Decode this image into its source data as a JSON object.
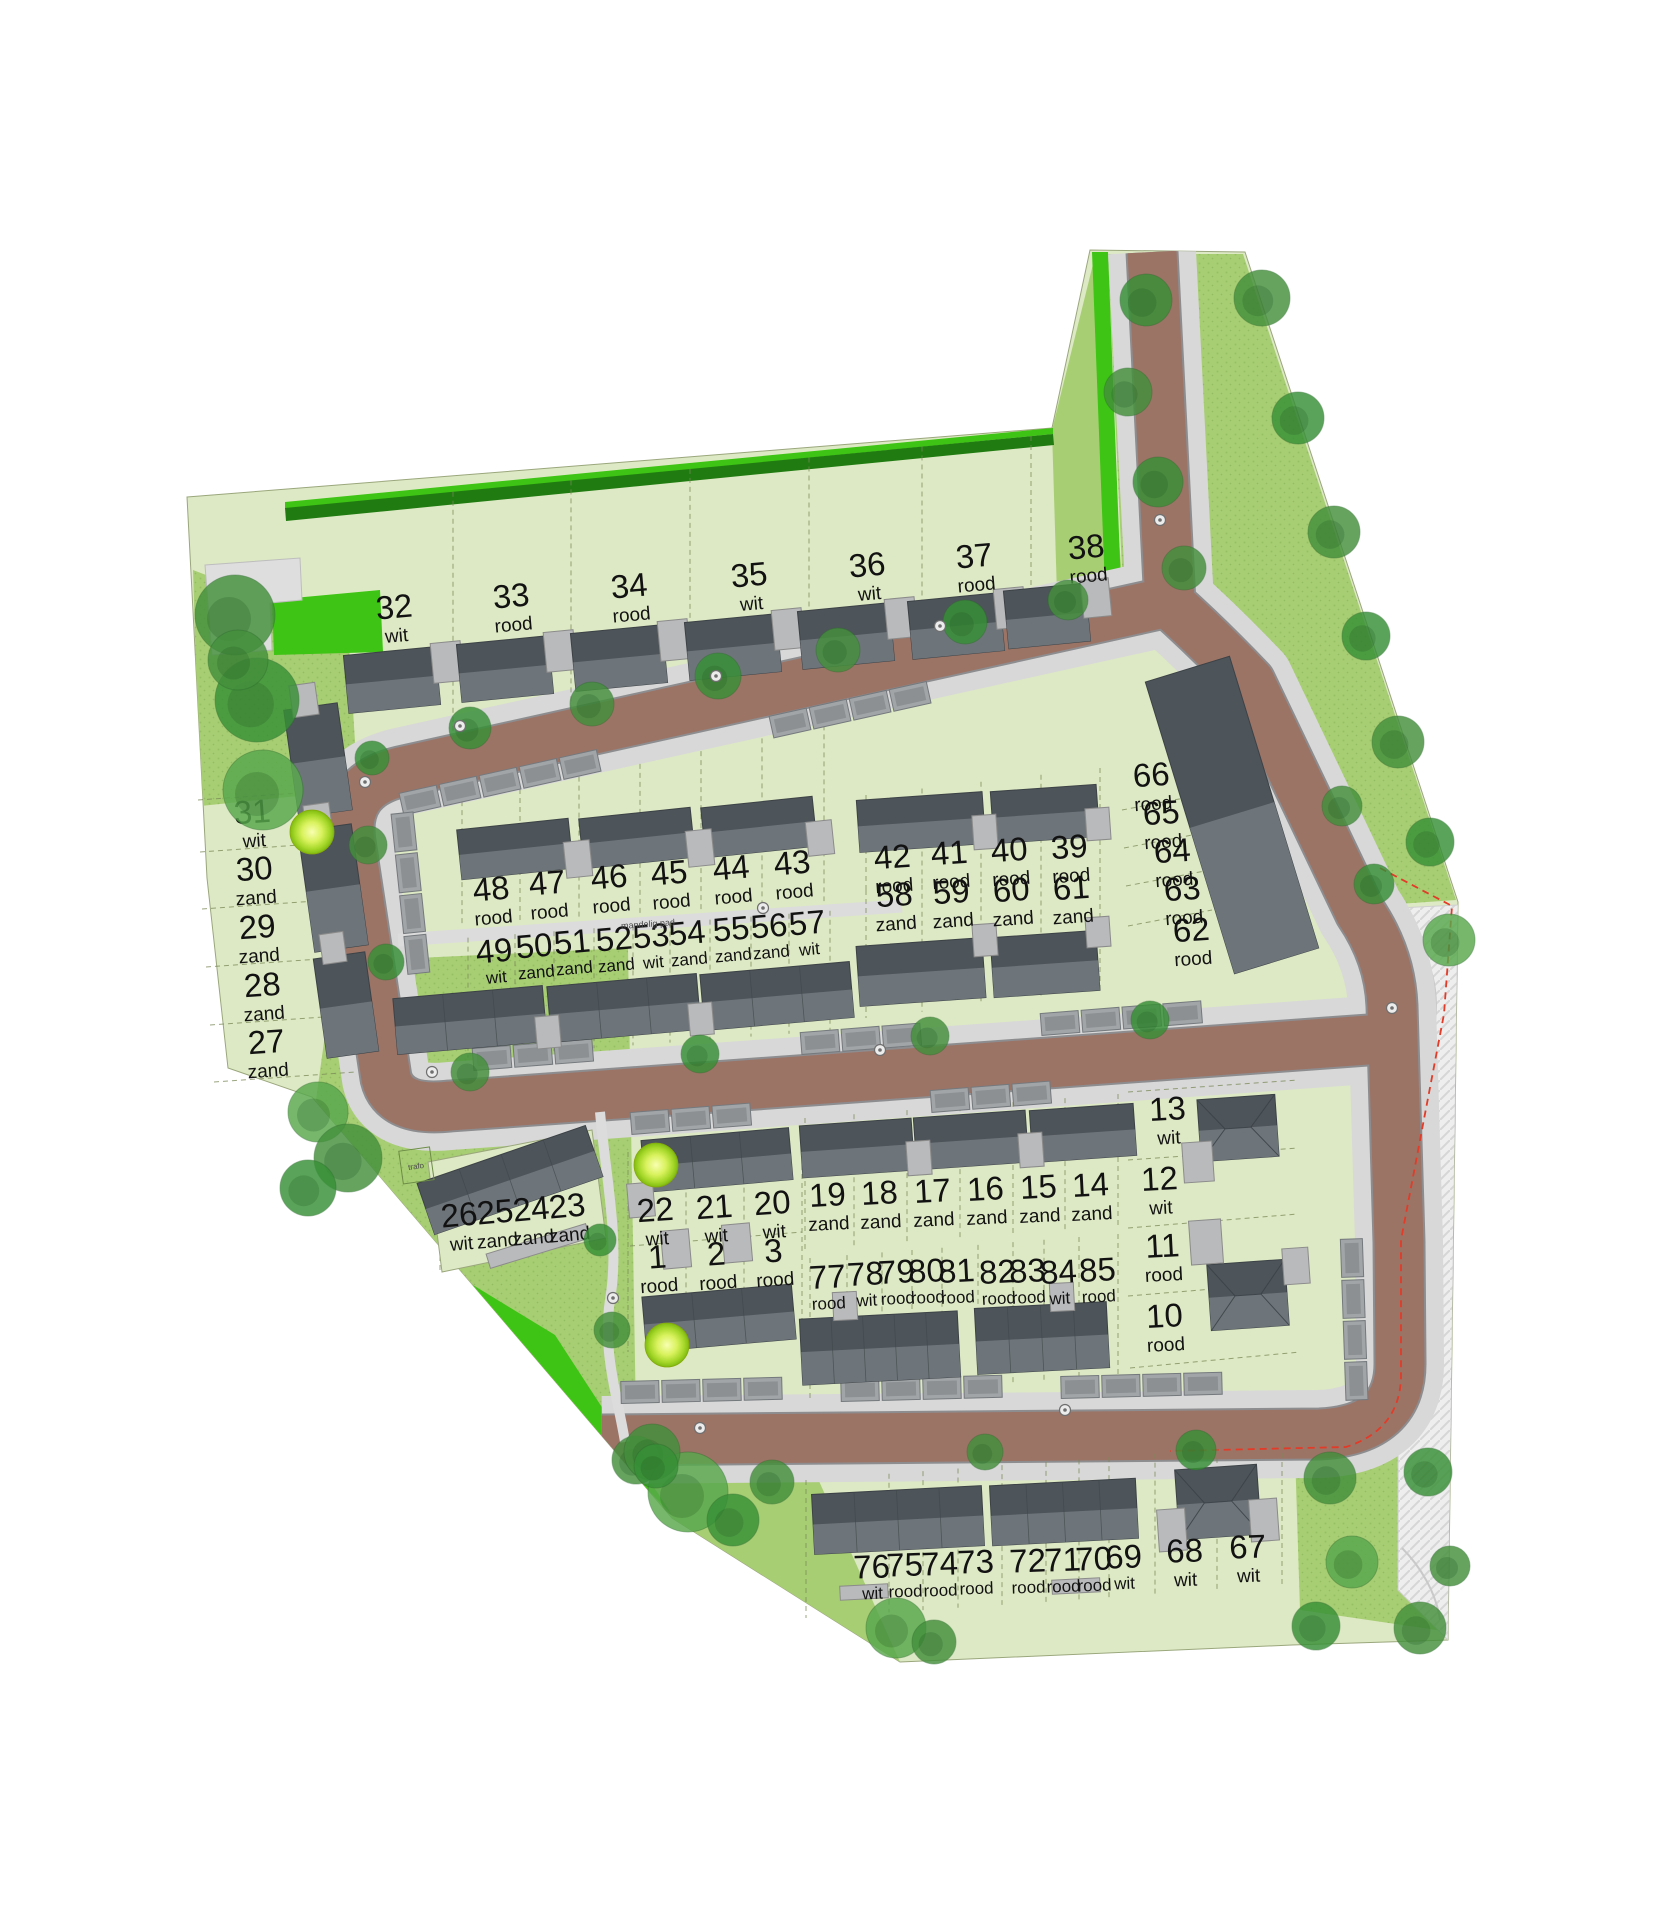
{
  "map": {
    "annotations": {
      "shared_path": "mandelig pad",
      "transformer": "trafo"
    },
    "palette": {
      "plot_green": "#dde9c4",
      "park_green": "#a8ce74",
      "vivid_green": "#3ec414",
      "dark_green": "#207c11",
      "road_brown": "#9c7466",
      "sidewalk_gray": "#d8d8d8",
      "building_dark": "#4d545a",
      "building_light": "#6e757a",
      "garage_gray": "#b9babb",
      "red_boundary": "#e23b28",
      "lime_marker": "#c9ef52",
      "tree_greens": [
        "#44903c",
        "#379036",
        "#58a84c",
        "#2f7f31"
      ]
    },
    "plots": [
      {
        "no": "1",
        "kleur": "rood"
      },
      {
        "no": "2",
        "kleur": "rood"
      },
      {
        "no": "3",
        "kleur": "rood"
      },
      {
        "no": "10",
        "kleur": "rood"
      },
      {
        "no": "11",
        "kleur": "rood"
      },
      {
        "no": "12",
        "kleur": "wit"
      },
      {
        "no": "13",
        "kleur": "wit"
      },
      {
        "no": "14",
        "kleur": "zand"
      },
      {
        "no": "15",
        "kleur": "zand"
      },
      {
        "no": "16",
        "kleur": "zand"
      },
      {
        "no": "17",
        "kleur": "zand"
      },
      {
        "no": "18",
        "kleur": "zand"
      },
      {
        "no": "19",
        "kleur": "zand"
      },
      {
        "no": "20",
        "kleur": "wit"
      },
      {
        "no": "21",
        "kleur": "wit"
      },
      {
        "no": "22",
        "kleur": "wit"
      },
      {
        "no": "23",
        "kleur": "zand"
      },
      {
        "no": "24",
        "kleur": "zand"
      },
      {
        "no": "25",
        "kleur": "zand"
      },
      {
        "no": "26",
        "kleur": "wit"
      },
      {
        "no": "27",
        "kleur": "zand"
      },
      {
        "no": "28",
        "kleur": "zand"
      },
      {
        "no": "29",
        "kleur": "zand"
      },
      {
        "no": "30",
        "kleur": "zand"
      },
      {
        "no": "31",
        "kleur": "wit"
      },
      {
        "no": "32",
        "kleur": "wit"
      },
      {
        "no": "33",
        "kleur": "rood"
      },
      {
        "no": "34",
        "kleur": "rood"
      },
      {
        "no": "35",
        "kleur": "wit"
      },
      {
        "no": "36",
        "kleur": "wit"
      },
      {
        "no": "37",
        "kleur": "rood"
      },
      {
        "no": "38",
        "kleur": "rood"
      },
      {
        "no": "39",
        "kleur": "rood"
      },
      {
        "no": "40",
        "kleur": "rood"
      },
      {
        "no": "41",
        "kleur": "rood"
      },
      {
        "no": "42",
        "kleur": "rood"
      },
      {
        "no": "43",
        "kleur": "rood"
      },
      {
        "no": "44",
        "kleur": "rood"
      },
      {
        "no": "45",
        "kleur": "rood"
      },
      {
        "no": "46",
        "kleur": "rood"
      },
      {
        "no": "47",
        "kleur": "rood"
      },
      {
        "no": "48",
        "kleur": "rood"
      },
      {
        "no": "49",
        "kleur": "wit"
      },
      {
        "no": "50",
        "kleur": "zand"
      },
      {
        "no": "51",
        "kleur": "zand"
      },
      {
        "no": "52",
        "kleur": "zand"
      },
      {
        "no": "53",
        "kleur": "wit"
      },
      {
        "no": "54",
        "kleur": "zand"
      },
      {
        "no": "55",
        "kleur": "zand"
      },
      {
        "no": "56",
        "kleur": "zand"
      },
      {
        "no": "57",
        "kleur": "wit"
      },
      {
        "no": "58",
        "kleur": "zand"
      },
      {
        "no": "59",
        "kleur": "zand"
      },
      {
        "no": "60",
        "kleur": "zand"
      },
      {
        "no": "61",
        "kleur": "zand"
      },
      {
        "no": "62",
        "kleur": "rood"
      },
      {
        "no": "63",
        "kleur": "rood"
      },
      {
        "no": "64",
        "kleur": "rood"
      },
      {
        "no": "65",
        "kleur": "rood"
      },
      {
        "no": "66",
        "kleur": "rood"
      },
      {
        "no": "67",
        "kleur": "wit"
      },
      {
        "no": "68",
        "kleur": "wit"
      },
      {
        "no": "69",
        "kleur": "wit"
      },
      {
        "no": "70",
        "kleur": "rood"
      },
      {
        "no": "71",
        "kleur": "rood"
      },
      {
        "no": "72",
        "kleur": "rood"
      },
      {
        "no": "73",
        "kleur": "rood"
      },
      {
        "no": "74",
        "kleur": "rood"
      },
      {
        "no": "75",
        "kleur": "rood"
      },
      {
        "no": "76",
        "kleur": "wit"
      },
      {
        "no": "77",
        "kleur": "rood"
      },
      {
        "no": "78",
        "kleur": "wit"
      },
      {
        "no": "79",
        "kleur": "rood"
      },
      {
        "no": "80",
        "kleur": "rood"
      },
      {
        "no": "81",
        "kleur": "rood"
      },
      {
        "no": "82",
        "kleur": "rood"
      },
      {
        "no": "83",
        "kleur": "rood"
      },
      {
        "no": "84",
        "kleur": "wit"
      },
      {
        "no": "85",
        "kleur": "rood"
      }
    ]
  }
}
